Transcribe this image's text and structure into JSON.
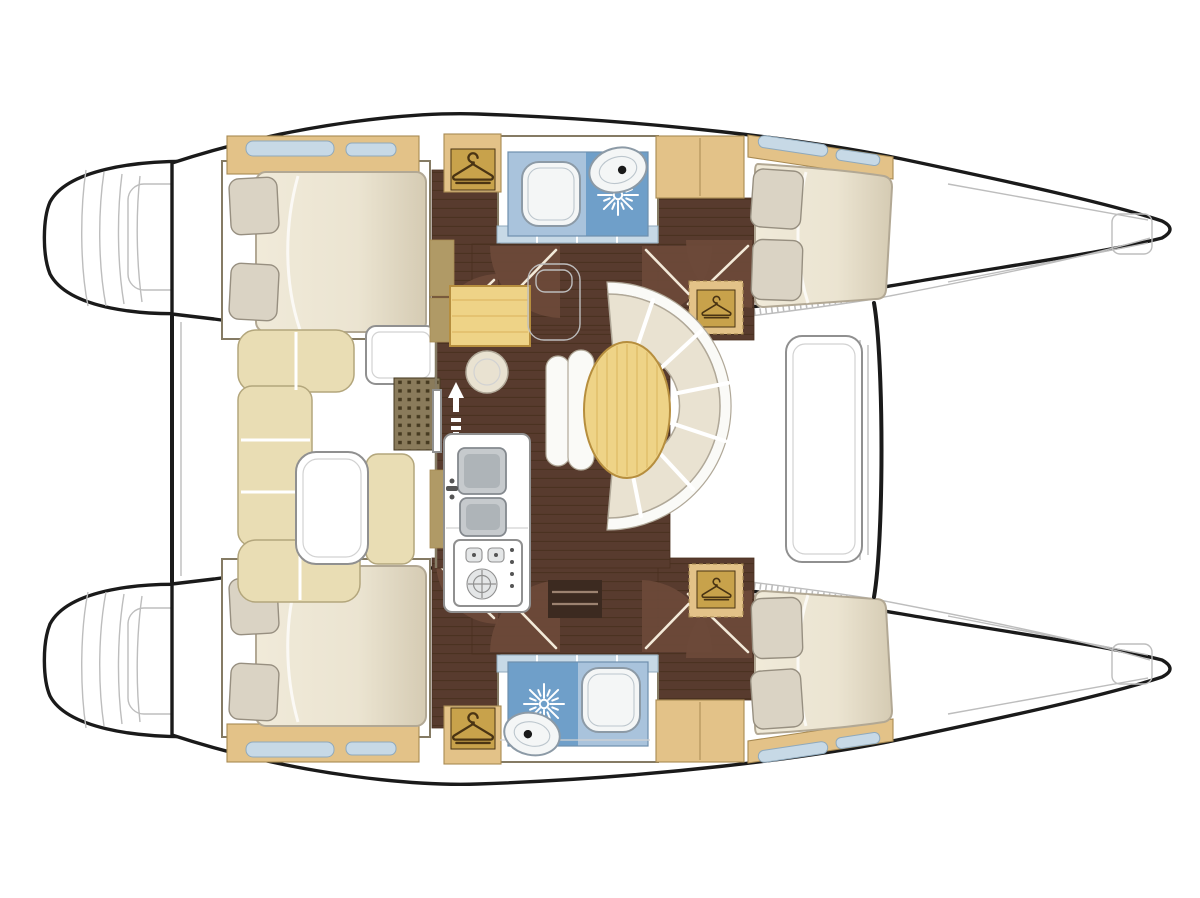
{
  "meta": {
    "description": "Catamaran sailing yacht interior layout plan, top-down view, bows pointing right",
    "visible_text": "none"
  },
  "rooms": {
    "port_aft_cabin": {
      "label": "Port aft double cabin with berth and pillows"
    },
    "port_head": {
      "label": "Port head with toilet, wash basin and shower"
    },
    "port_forward_cabin": {
      "label": "Port forward double cabin with berth and pillows"
    },
    "starboard_aft_cabin": {
      "label": "Starboard aft double cabin with berth and pillows"
    },
    "starboard_head": {
      "label": "Starboard head with toilet, wash basin and shower"
    },
    "starboard_forward_cabin": {
      "label": "Starboard forward double cabin with berth and pillows"
    },
    "salon": {
      "label": "Salon with wrap-around settee and oval table"
    },
    "nav_station": {
      "label": "Chart table with stool"
    },
    "galley": {
      "label": "Galley with double sink and stove"
    },
    "cockpit": {
      "label": "Aft cockpit with bench seating and table"
    },
    "foredeck": {
      "label": "Foredeck between bows"
    },
    "port_bow": {
      "label": "Port bow with anchor locker"
    },
    "starboard_bow": {
      "label": "Starboard bow"
    },
    "port_transom": {
      "label": "Port transom steps and swim platform"
    },
    "starboard_transom": {
      "label": "Starboard transom steps and swim platform"
    }
  },
  "icons": {
    "hanger": {
      "name": "hanger-icon",
      "meaning": "wardrobe / hanging locker",
      "count": 4
    },
    "shower": {
      "name": "shower-icon",
      "meaning": "shower drain sunburst",
      "count": 2
    },
    "toilet": {
      "name": "toilet-icon",
      "meaning": "marine toilet",
      "count": 2
    },
    "basin": {
      "name": "basin-icon",
      "meaning": "wash basin with tap",
      "count": 2
    },
    "sink": {
      "name": "double-sink-icon",
      "meaning": "galley double sink",
      "count": 1
    },
    "stove": {
      "name": "stove-icon",
      "meaning": "galley stove with burners",
      "count": 1
    },
    "stairs": {
      "name": "companionway-arrows-icon",
      "meaning": "entry steps up/down arrows",
      "count": 1
    },
    "grate": {
      "name": "floor-grate-icon",
      "meaning": "dotted cockpit grate mat",
      "count": 1
    }
  },
  "counts": {
    "cabins": 4,
    "heads": 2,
    "hulls": 2,
    "wardrobes": 4
  },
  "colors": {
    "white": "#ffffff",
    "outline": "#1a1a1a",
    "sketch": "#bdbdbd",
    "wall": "#857b64",
    "gray_line": "#909090",
    "faint_line": "#d2d2d2",
    "wood_floor": "#583b2e",
    "wood_line": "#49301f",
    "door_arc": "#6d4a39",
    "door_line": "#f3ead9",
    "tan_shelf": "#e3c288",
    "tan_dark": "#c8a24b",
    "tan_border": "#a88a52",
    "tan_slot": "#f0e4c6",
    "khaki_wall": "#b09a66",
    "glass": "#c7d9e6",
    "glass_line": "#8fa9bc",
    "mattress_line": "#b2a894",
    "pillow": "#dad3c4",
    "pillow_line": "#978f80",
    "cushion": "#e9e2d1",
    "cushion_line": "#b0a898",
    "seat_back": "#fafaf7",
    "cockpit_cushion": "#e9ddb4",
    "cockpit_cushion_line": "#b3a67c",
    "table_wood": "#eed387",
    "table_border": "#b68e3e",
    "table_grain": "#e0bd6a",
    "bath_light": "#a9c3dc",
    "bath_dark": "#6f9fc9",
    "bath_line": "#6e8fae",
    "fixture": "#f4f6f6",
    "fixture_line": "#8c9aa6",
    "fixture_faint": "#bcc6cd",
    "steel": "#c6cacd",
    "steel_line": "#84898e",
    "steel_dark": "#aeb4b8",
    "dark_step": "#3c2a20",
    "step_line": "#9c8270",
    "grate": "#8a7b5b",
    "grate_dot": "#463a20",
    "hanger": "#4a3413",
    "knob": "#e4e6e7",
    "dot": "#555555",
    "bed_hi": "#f0ead9",
    "bed_mid": "#ebe4d1",
    "bed_lo": "#d5cbb3"
  }
}
